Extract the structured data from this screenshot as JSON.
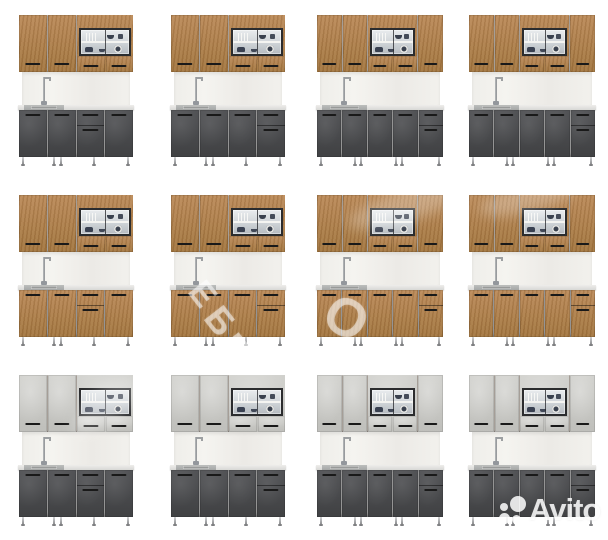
{
  "page": {
    "width": 608,
    "height": 540,
    "background": "#ffffff",
    "description": "Photo collage of 12 modular kitchen set renders, 4 columns by 3 rows"
  },
  "grid": {
    "rows": 3,
    "cols": 4,
    "cell_width": 152,
    "cell_height": 180
  },
  "colors": {
    "wood_light": "#bb8a58",
    "wood_dark": "#a3763f",
    "dark_light": "#525356",
    "dark_dark": "#404143",
    "light_light": "#d0d0cc",
    "light_dark": "#bfbfbb",
    "glass_frame": "#2b2c2e",
    "handle": "#191919",
    "backsplash": "#f1f0ec",
    "counter": "#e0e0dd",
    "sink_steel": "#a9abaa",
    "leg_chrome": "#9b9c9e"
  },
  "kitchens": [
    {
      "row": 0,
      "col": 0,
      "size": "compact",
      "upper_finish": "wood",
      "lower_finish": "dark",
      "drawer_column": 2
    },
    {
      "row": 0,
      "col": 1,
      "size": "compact",
      "upper_finish": "wood",
      "lower_finish": "dark",
      "drawer_column": 3
    },
    {
      "row": 0,
      "col": 2,
      "size": "wide",
      "upper_finish": "wood",
      "lower_finish": "dark",
      "drawer_column": 4
    },
    {
      "row": 0,
      "col": 3,
      "size": "wide",
      "upper_finish": "wood",
      "lower_finish": "dark",
      "drawer_column": 4
    },
    {
      "row": 1,
      "col": 0,
      "size": "compact",
      "upper_finish": "wood",
      "lower_finish": "wood",
      "drawer_column": 2
    },
    {
      "row": 1,
      "col": 1,
      "size": "compact",
      "upper_finish": "wood",
      "lower_finish": "wood",
      "drawer_column": 3
    },
    {
      "row": 1,
      "col": 2,
      "size": "wide",
      "upper_finish": "wood",
      "lower_finish": "wood",
      "drawer_column": 4
    },
    {
      "row": 1,
      "col": 3,
      "size": "wide",
      "upper_finish": "wood",
      "lower_finish": "wood",
      "drawer_column": 4
    },
    {
      "row": 2,
      "col": 0,
      "size": "compact",
      "upper_finish": "light",
      "lower_finish": "dark",
      "drawer_column": 2
    },
    {
      "row": 2,
      "col": 1,
      "size": "compact",
      "upper_finish": "light",
      "lower_finish": "dark",
      "drawer_column": 3
    },
    {
      "row": 2,
      "col": 2,
      "size": "wide",
      "upper_finish": "light",
      "lower_finish": "dark",
      "drawer_column": 4
    },
    {
      "row": 2,
      "col": 3,
      "size": "wide",
      "upper_finish": "light",
      "lower_finish": "dark",
      "drawer_column": 4
    }
  ],
  "watermarks": {
    "diagonal_letters": [
      {
        "char": "Е",
        "x": 191,
        "y": 277,
        "size": 34,
        "rot": 52
      },
      {
        "char": "Б",
        "x": 207,
        "y": 303,
        "size": 36,
        "rot": 52
      },
      {
        "char": "Е",
        "x": 223,
        "y": 330,
        "size": 34,
        "rot": 52
      },
      {
        "char": "О",
        "x": 325,
        "y": 291,
        "size": 54,
        "rot": 30
      }
    ],
    "smudges": [
      {
        "x": 345,
        "y": 188,
        "w": 130,
        "h": 32,
        "rot": -18
      },
      {
        "x": 478,
        "y": 184,
        "w": 100,
        "h": 28,
        "rot": -14
      },
      {
        "x": 66,
        "y": 388,
        "w": 80,
        "h": 36,
        "rot": -40
      }
    ],
    "avito": {
      "label": "Avito"
    }
  }
}
